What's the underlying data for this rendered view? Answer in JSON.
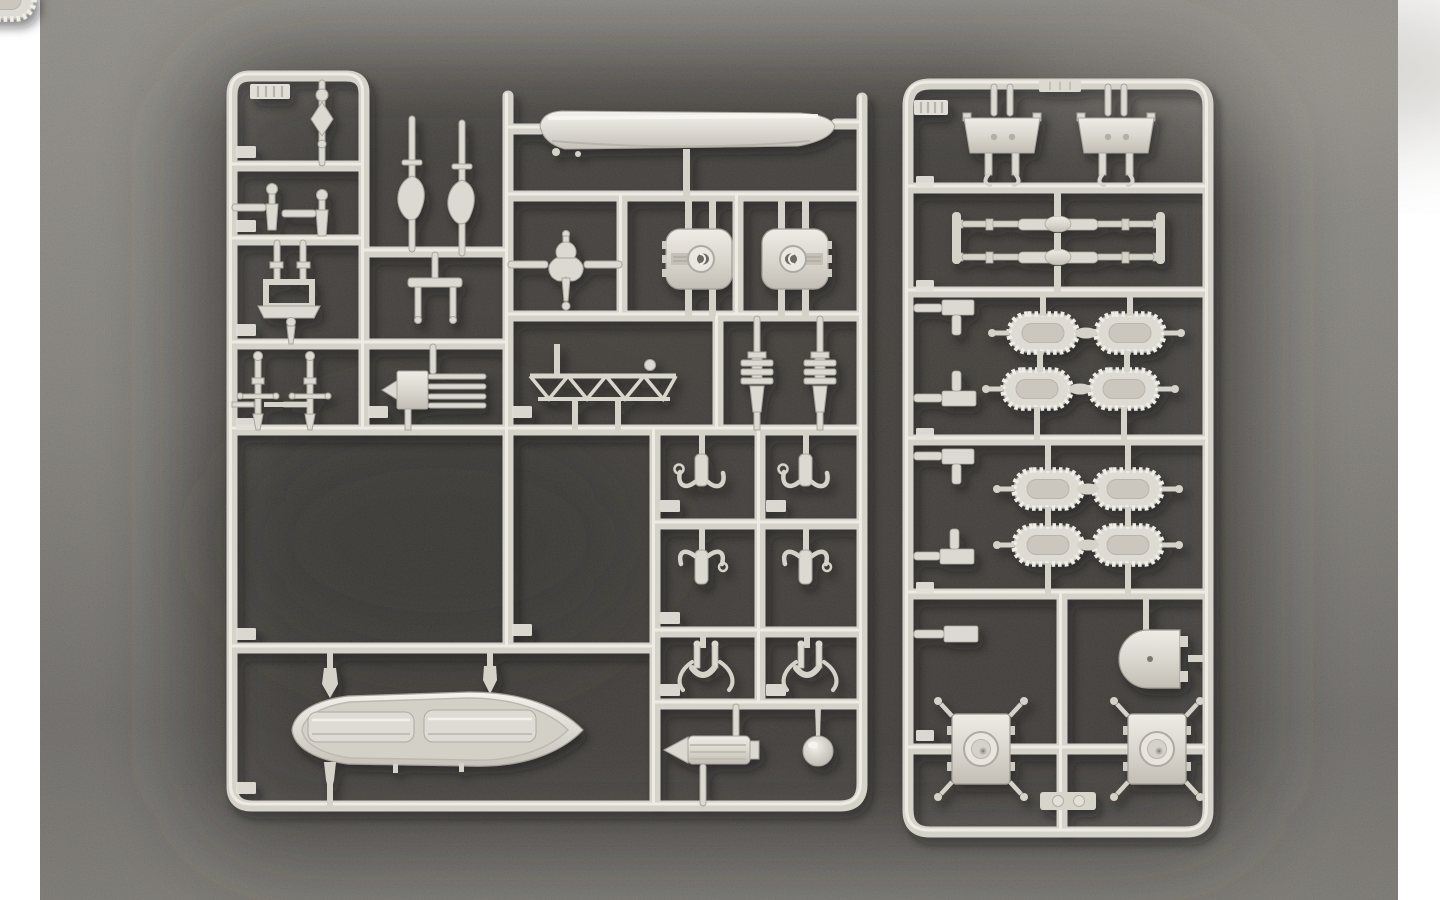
{
  "scene": {
    "description": "Photograph of two light-gray injection-molded plastic model kit sprues (warship fittings: ship's boats, gun turrets, davits, masts and carley-float life rafts) lying on a dark speckled mat, with white borders at the left and right edges of the photo",
    "photo": {
      "white_border_left_px": 40,
      "white_border_right_px": 42
    },
    "colors": {
      "border_white": "#ffffff",
      "surface_top": "#8c8983",
      "surface_mid": "#7d7a74",
      "surface_low": "#676460",
      "surface_bottom": "#74716b",
      "mat_dark": "#302e2b",
      "mat_core": "#272624",
      "plastic_rail": "#d5d2ca",
      "plastic_highlight": "#f2f0ea",
      "plastic_base": "#dcd9d2",
      "plastic_shade": "#a9a59d",
      "plastic_deep": "#6e6a63"
    },
    "sprues": [
      {
        "id": "left-sprue",
        "label_tab": "illegible embossed markings",
        "parts": [
          {
            "part": "large ship's boat hull (molded keel-up)",
            "qty": 1
          },
          {
            "part": "whaleboat with two cover panels",
            "qty": 1
          },
          {
            "part": "twin-gun turret housings",
            "qty": 2
          },
          {
            "part": "small knob fitting",
            "qty": 1
          },
          {
            "part": "bollard / winch fittings",
            "qty": 2
          },
          {
            "part": "stocked anchors on long runners",
            "qty": 2
          },
          {
            "part": "pedestal frame with base plate",
            "qty": 1
          },
          {
            "part": "table stand fitting",
            "qty": 1
          },
          {
            "part": "ornate anchor fitting",
            "qty": 1
          },
          {
            "part": "masts with yard arms",
            "qty": 2
          },
          {
            "part": "multi-tube rack fitting",
            "qty": 1
          },
          {
            "part": "lattice girder / truss section",
            "qty": 1
          },
          {
            "part": "tiered stack fittings",
            "qty": 2
          },
          {
            "part": "boat davits",
            "qty": 4
          },
          {
            "part": "grapnel claw fittings",
            "qty": 2
          },
          {
            "part": "spool / drum fitting",
            "qty": 1
          },
          {
            "part": "spherical dome fitting",
            "qty": 1
          },
          {
            "part": "molded part-number tabs (markings illegible)",
            "qty": 14
          }
        ]
      },
      {
        "id": "right-sprue",
        "label_tab": "illegible embossed markings",
        "parts": [
          {
            "part": "deckhouse blocks with leg stubs",
            "qty": 2
          },
          {
            "part": "double-ended gun / tube mounts",
            "qty": 2
          },
          {
            "part": "carley-float life rafts (scalloped ovals)",
            "qty": 8
          },
          {
            "part": "bracket fittings on left runner",
            "qty": 5
          },
          {
            "part": "D-shaped turret housing",
            "qty": 1
          },
          {
            "part": "square turret bases with round dome",
            "qty": 2
          },
          {
            "part": "molded part-number tabs (markings illegible)",
            "qty": 7
          }
        ]
      }
    ]
  }
}
